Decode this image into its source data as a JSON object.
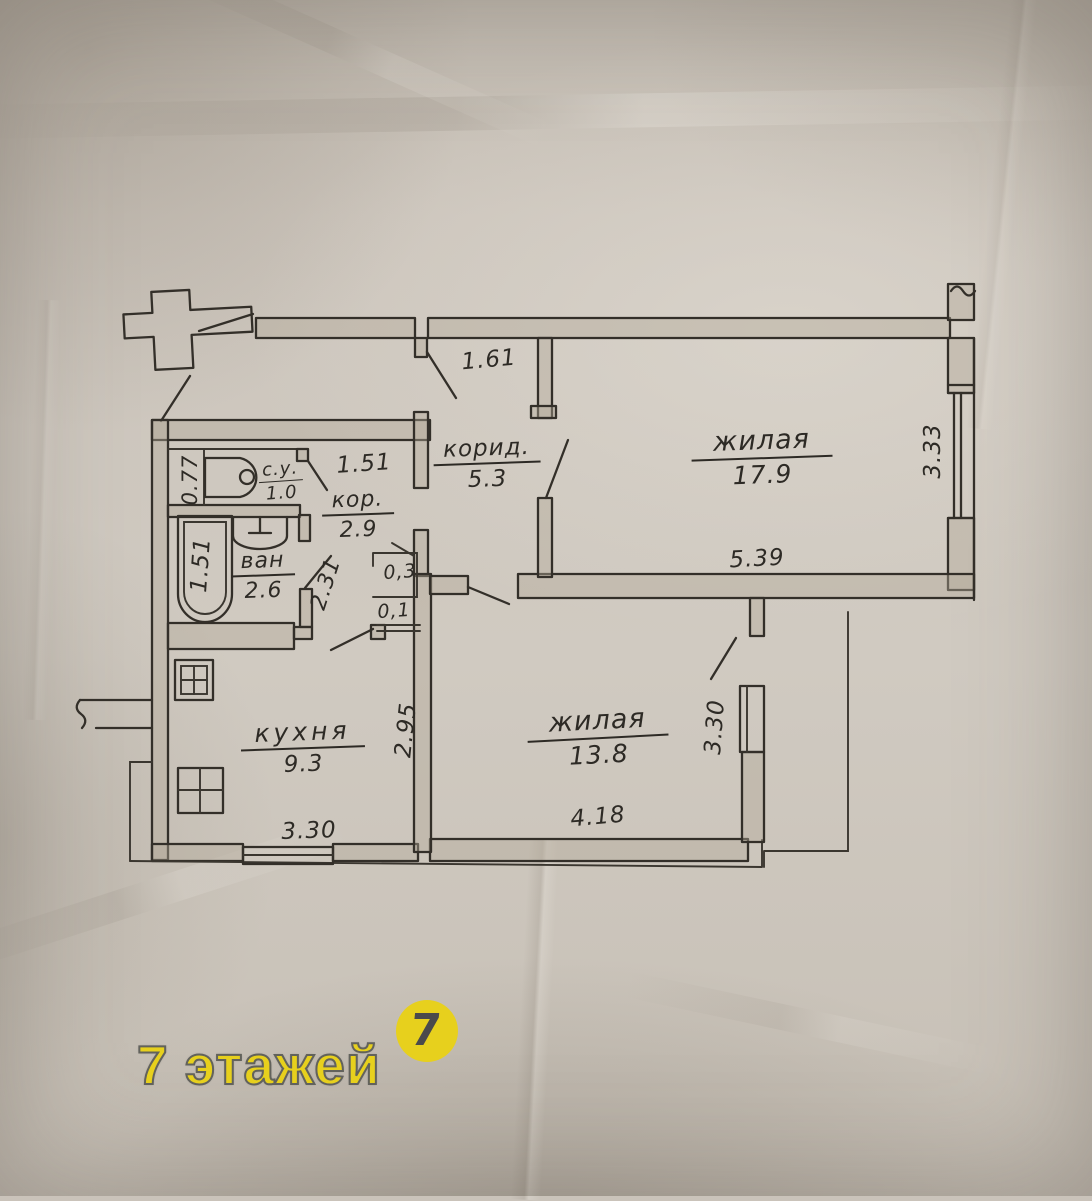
{
  "paper": {
    "background_color": "#cac3ba",
    "ink_color": "#332f29"
  },
  "rooms": {
    "corridor_main": {
      "name": "корид.",
      "area": "5.3"
    },
    "living_large": {
      "name": "жилая",
      "area": "17.9"
    },
    "toilet": {
      "name": "с.у.",
      "area": "1.0"
    },
    "corridor_small": {
      "name": "кор.",
      "area": "2.9"
    },
    "bath": {
      "name": "ван",
      "area": "2.6"
    },
    "kitchen": {
      "name": "кухня",
      "area": "9.3"
    },
    "living_small": {
      "name": "жилая",
      "area": "13.8"
    }
  },
  "dimensions": {
    "entry_opening": "1.61",
    "hall_width": "1.51",
    "toilet_width": "0.77",
    "bath_length": "1.51",
    "bath_depth": "2.31",
    "niche_large": "0,3",
    "niche_small": "0,1",
    "living_large_width": "5.39",
    "living_large_depth": "3.33",
    "kitchen_depth": "2.95",
    "kitchen_width": "3.30",
    "living_small_width": "4.18",
    "living_small_depth": "3.30"
  },
  "watermark": {
    "brand_text": "7 этажей",
    "logo_digit": "7",
    "color": "#e7d01d"
  }
}
